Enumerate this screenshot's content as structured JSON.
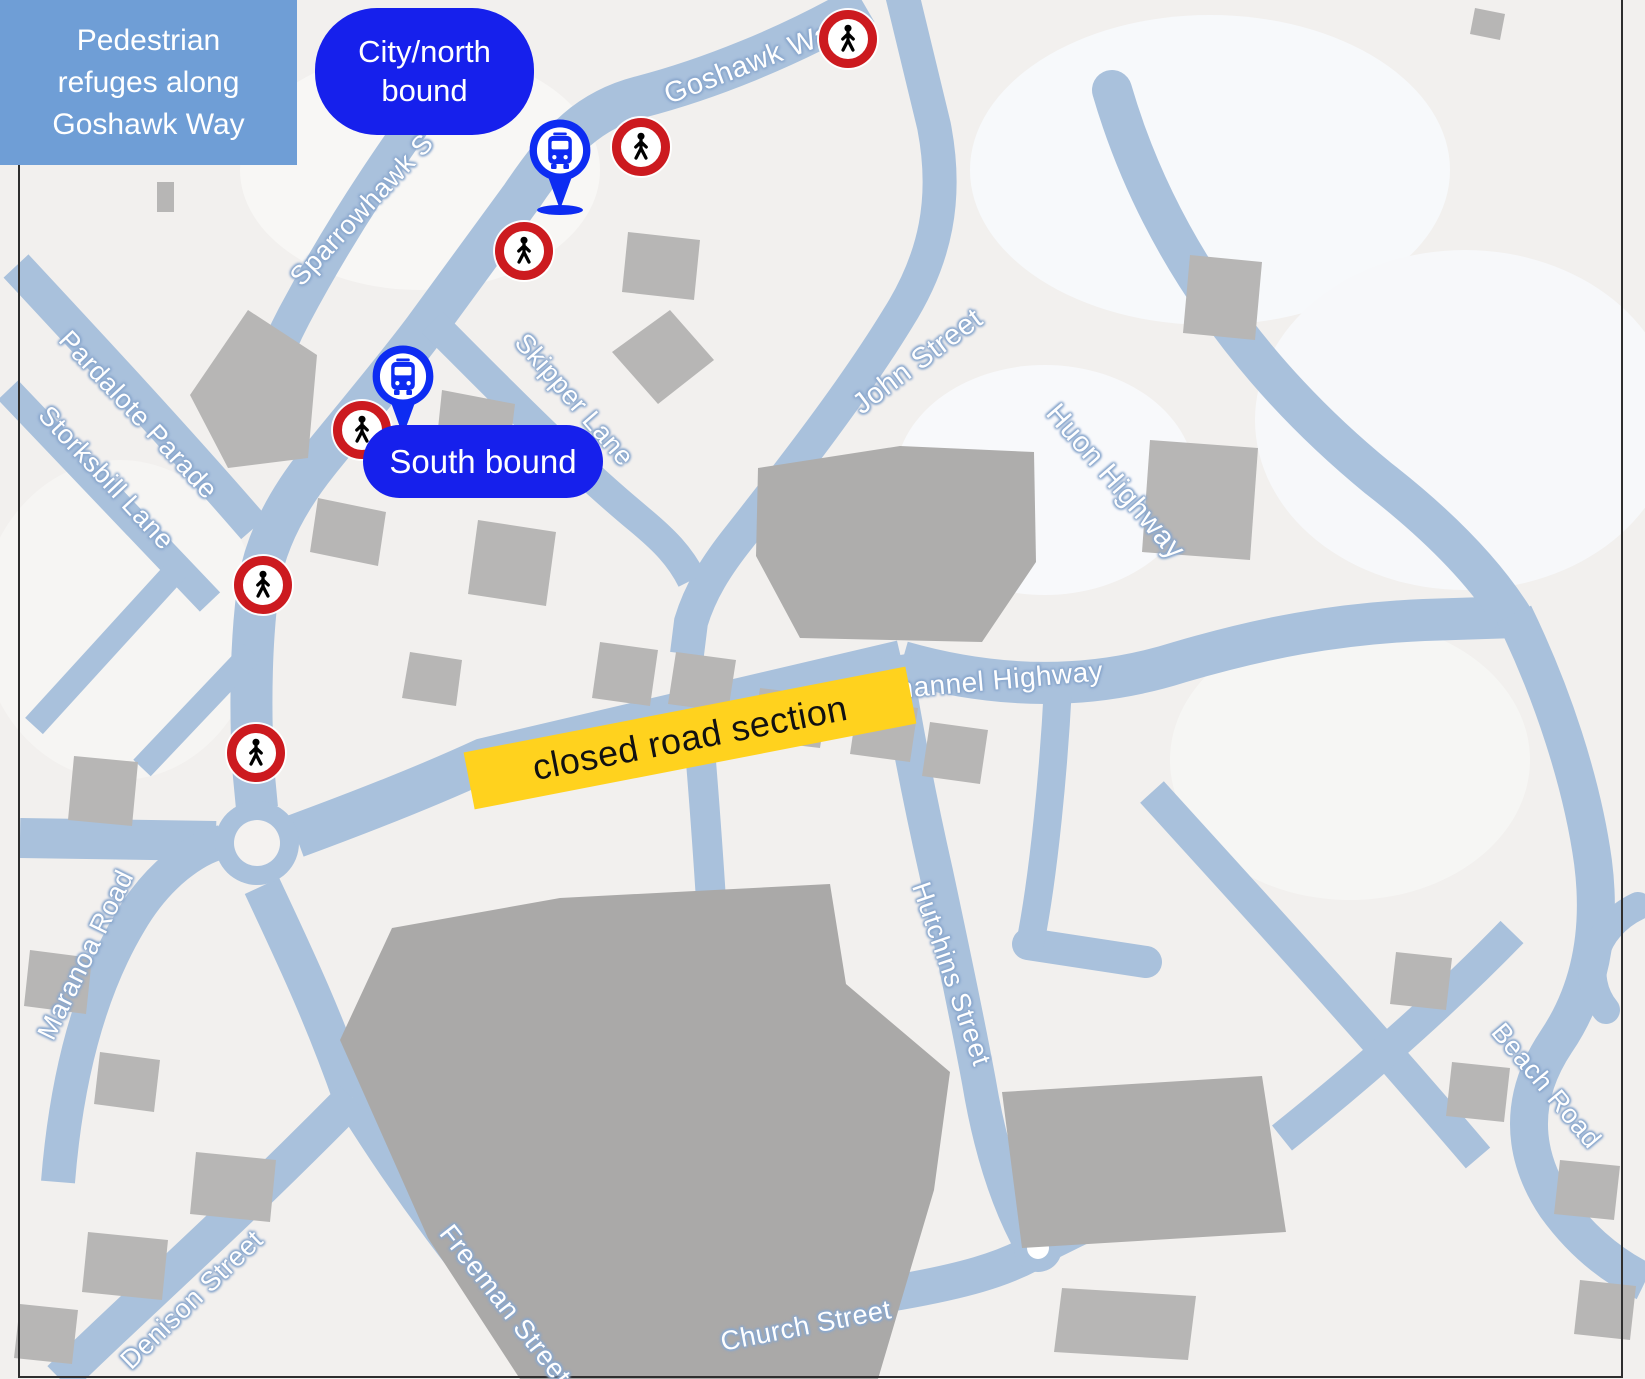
{
  "title_card": {
    "line1": "Pedestrian",
    "line2": "refuges along",
    "line3": "Goshawk Way"
  },
  "callouts": {
    "north_bound": "City/north bound",
    "south_bound": "South bound",
    "closed_road": "closed road section"
  },
  "streets": {
    "goshawk": "Goshawk Way",
    "sparrowhawk": "Sparrowhawk S",
    "skipper": "Skipper Lane",
    "pardalote": "Pardalote Parade",
    "storksbill": "Storksbill Lane",
    "john": "John Street",
    "huon": "Huon Highway",
    "channel": "Channel Highway",
    "hutchins": "Hutchins Street",
    "maranoa": "Maranoa Road",
    "denison": "Denison Street",
    "freeman": "Freeman Street",
    "church": "Church Street",
    "beach": "Beach Road"
  },
  "markers": {
    "pedestrian_refuge_icon": "pedestrian-crossing-roundel",
    "pedestrian_refuge_count": 6,
    "bus_stop_icon": "bus-stop-pin",
    "bus_stop_count": 2
  },
  "colors": {
    "background": "#f2f0ee",
    "road": "#a9c1dc",
    "building": "#b7b6b5",
    "title_panel_blue": "#6f9ed6",
    "callout_blue": "#1620ec",
    "pin_blue": "#0d2cf2",
    "refuge_red": "#cc1a1f",
    "closed_yellow": "#ffd21e"
  }
}
